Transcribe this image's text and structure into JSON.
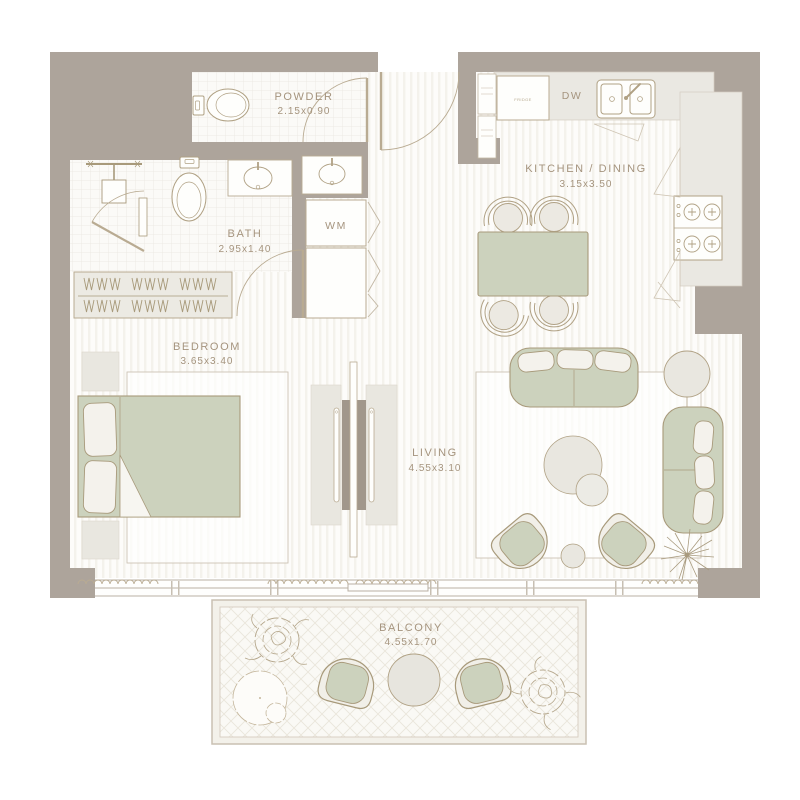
{
  "palette": {
    "wall": "#ada49b",
    "floor": "#fdfcfa",
    "furniture_green": "#ccd2bd",
    "outline_tan": "#a89a7b",
    "fixture_gray": "#e9e7e0",
    "counter_gray": "#eae8e2",
    "label_text": "#a5947e"
  },
  "rooms": {
    "powder": {
      "name": "POWDER",
      "dimensions": "2.15x0.90"
    },
    "bath": {
      "name": "BATH",
      "dimensions": "2.95x1.40"
    },
    "bedroom": {
      "name": "BEDROOM",
      "dimensions": "3.65x3.40"
    },
    "kitchen": {
      "name": "KITCHEN / DINING",
      "dimensions": "3.15x3.50"
    },
    "living": {
      "name": "LIVING",
      "dimensions": "4.55x3.10"
    },
    "balcony": {
      "name": "BALCONY",
      "dimensions": "4.55x1.70"
    }
  },
  "appliances": {
    "washing_machine": "WM",
    "dishwasher": "DW",
    "fridge": "FRIDGE"
  }
}
